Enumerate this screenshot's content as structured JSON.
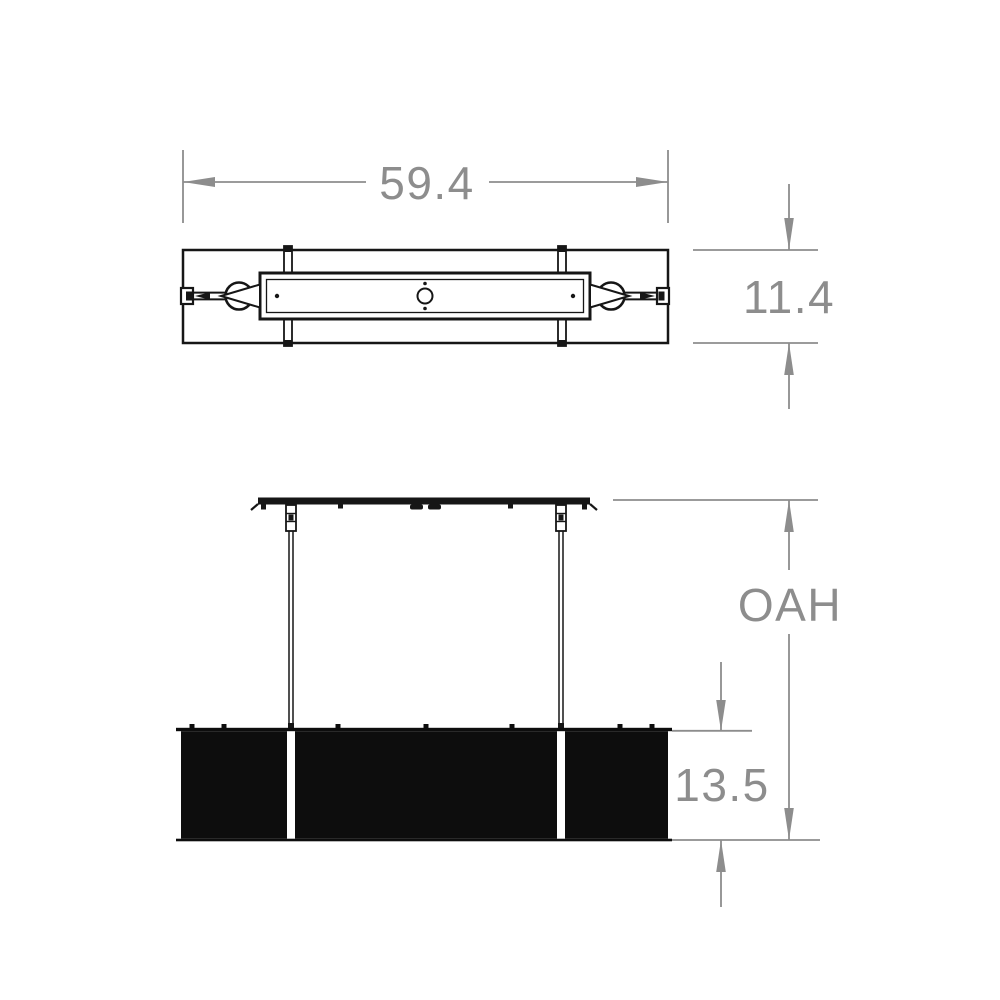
{
  "drawing": {
    "kind": "linear-suspension-fixture-dimension-drawing",
    "dimensions": {
      "width": "59.4",
      "depth": "11.4",
      "overall_height": "OAH",
      "shade_height": "13.5"
    },
    "colors": {
      "background": "#ffffff",
      "line": "#161616",
      "shade_fill": "#0d0d0d",
      "dimension": "#8d8d8d"
    }
  }
}
